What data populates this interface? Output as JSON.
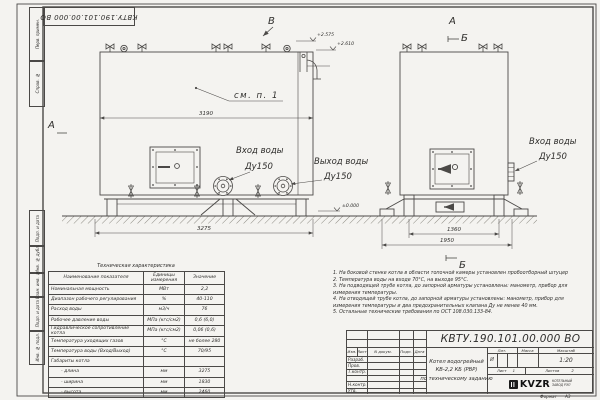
{
  "stamp": {
    "doc_number": "КВТУ.190.101.00.000 ВО"
  },
  "margin": {
    "labels": [
      "Перв. примен.",
      "Справ. №",
      "Подп. и дата",
      "Инв. № дубл.",
      "Взам. инв. №",
      "Подп. и дата",
      "Инв. № подл."
    ]
  },
  "drawing": {
    "view_b": "В",
    "view_a_front": "А",
    "view_a_side": "А",
    "section_b_top": "Б",
    "section_b_bottom": "Б",
    "see_item": "см. п. 1",
    "elev_roof": "+2.575",
    "elev_pipe": "+2.610",
    "elev_zero": "±0.000",
    "front": {
      "dim_body": "3190",
      "dim_overall": "3275",
      "inlet_title": "Вход воды",
      "inlet_dn": "Ду150",
      "outlet_title": "Выход воды",
      "outlet_dn": "Ду150"
    },
    "side": {
      "dim_base": "1360",
      "dim_overall": "1950",
      "inlet_title": "Вход воды",
      "inlet_dn": "Ду150"
    }
  },
  "spec_table": {
    "title": "Техническая характеристика",
    "headers": [
      "Наименование показателя",
      "Единицы измерения",
      "Значение"
    ],
    "rows": [
      [
        "Номинальная мощность",
        "МВт",
        "2,2"
      ],
      [
        "Диапазон рабочего регулирования",
        "%",
        "40-110"
      ],
      [
        "Расход воды",
        "м3/ч",
        "76"
      ],
      [
        "Рабочее давление воды",
        "МПа (кгс/см2)",
        "0,6 (6,0)"
      ],
      [
        "Гидравлическое сопротивление котла",
        "МПа (кгс/см2)",
        "0,06 (0,6)"
      ],
      [
        "Температура уходящих газов",
        "°С",
        "не более 280"
      ],
      [
        "Температура воды (Вход/Выход)",
        "°С",
        "70/95"
      ],
      [
        "Габариты котла",
        "",
        ""
      ],
      [
        "- длина",
        "мм",
        "3275"
      ],
      [
        "- ширина",
        "мм",
        "1830"
      ],
      [
        "- высота",
        "мм",
        "2460"
      ]
    ]
  },
  "notes": {
    "items": [
      "1.  На боковой стенке котла в области топочной камеры установлен пробоотборный штуцер",
      "2.  Температура воды на входе 70°С, на выходе 95°С.",
      "3.  На подводящей трубе котла, до запорной арматуры установлены: манометр, прибор для измерения температуры.",
      "4.  На отводящей трубе котла, до запорной арматуры установлены: манометр, прибор для измерения температуры и два предохранительных клапана Ду не менее 40 мм.",
      "5.  Остальные технические требования по ОСТ 108.030.133-84."
    ]
  },
  "title_block": {
    "doc_number": "КВТУ.190.101.00.000  ВО",
    "product_title_1": "Котел водогрейный",
    "product_title_2": "КВ-2,2 КБ (РВР)",
    "product_title_3": "по техническому заданию",
    "col_headers": [
      "Изм.",
      "Лист",
      "N докум.",
      "Подп.",
      "Дата"
    ],
    "row_labels": [
      "Разраб.",
      "Пров.",
      "Т.контр.",
      "Н.контр.",
      "Утв."
    ],
    "lit_label": "Лит.",
    "lit_value": "И",
    "mass_label": "Масса",
    "scale_label": "Масштаб",
    "scale_value": "1:20",
    "sheet_label": "Лист",
    "sheet_value": "1",
    "sheets_label": "Листов",
    "sheets_value": "2",
    "company_logo": "KVZR",
    "company_line1": "КОТЕЛЬНЫЙ",
    "company_line2": "ЗАВОД РЭП",
    "format_label": "Формат",
    "format_value": "А3"
  }
}
